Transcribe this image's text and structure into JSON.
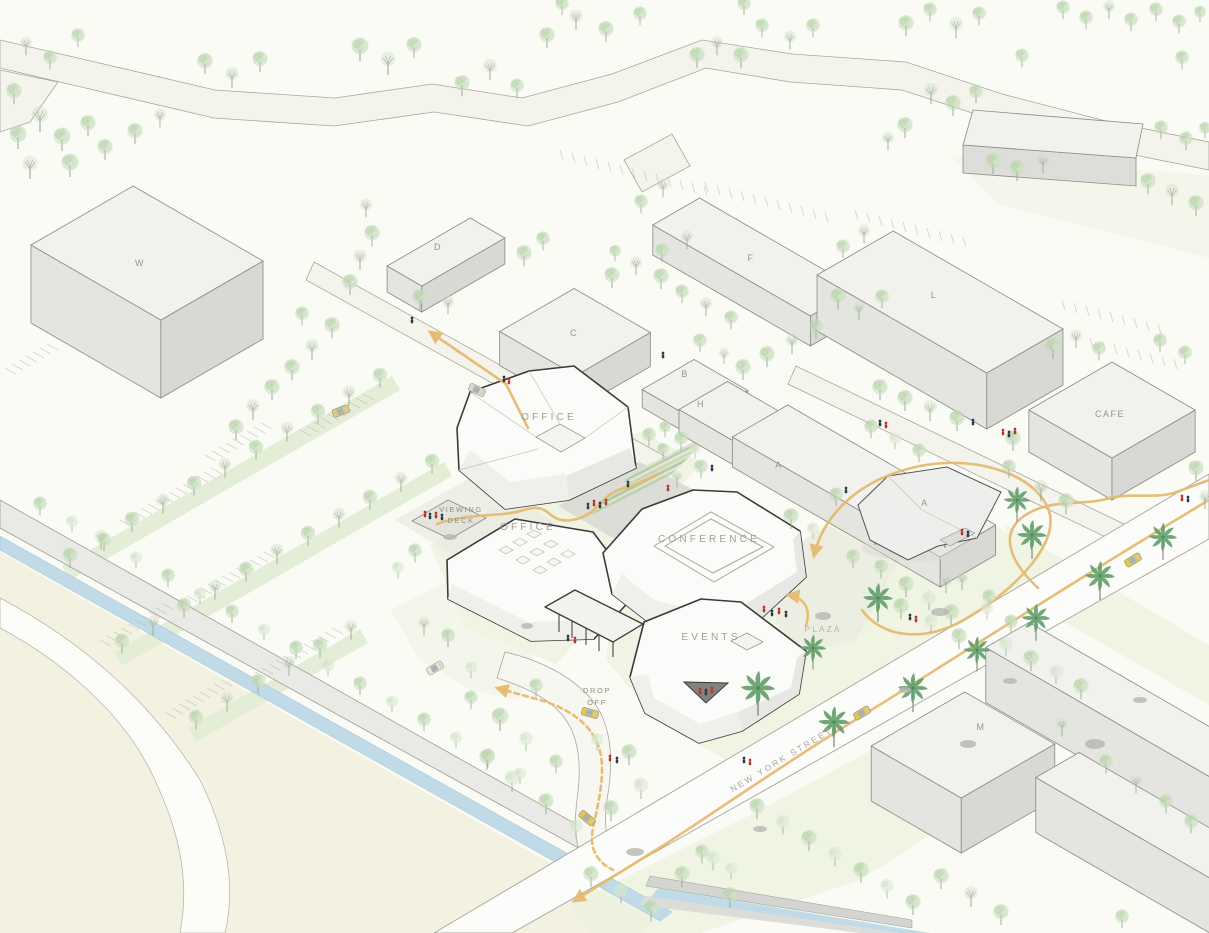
{
  "labels": {
    "building_w": "W",
    "building_d": "D",
    "building_c": "C",
    "building_b": "B",
    "building_h": "H",
    "building_a_block": "A",
    "building_f": "F",
    "building_l": "L",
    "building_m": "M",
    "building_a_pavilion": "A",
    "cafe": "CAFE",
    "office_north": "OFFICE",
    "office_south": "OFFICE",
    "conference": "CONFERENCE",
    "events": "EVENTS",
    "viewing_deck_line1": "VIEWING",
    "viewing_deck_line2": "DECK",
    "drop_off_line1": "DROP",
    "drop_off_line2": "OFF",
    "plaza": "PLAZA",
    "street_name": "NEW YORK STREET"
  },
  "colors": {
    "background": "#fbfbf6",
    "field": "#f3f2e1",
    "lawn": "#edf2e0",
    "water": "#c0dbe7",
    "route_accent": "#e6ba70",
    "context_building_top": "#f1f1ee",
    "featured_building": "#fbfbf9",
    "building_outline": "#3a3a38",
    "tree_foliage": "#c4dbba",
    "palm_foliage": "#64a06c",
    "people_red": "#b8352e",
    "people_dark": "#303845",
    "taxi_yellow": "#e7c64d"
  }
}
